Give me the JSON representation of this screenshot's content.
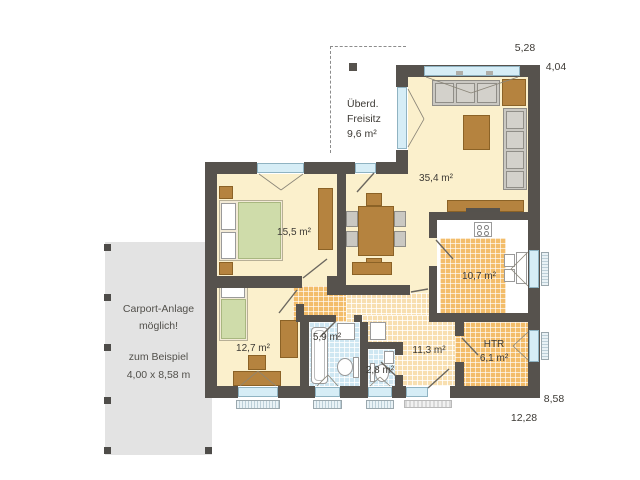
{
  "plan": {
    "rooms": [
      {
        "id": "living",
        "area_label": "35,4 m²"
      },
      {
        "id": "bedroom",
        "area_label": "15,5 m²"
      },
      {
        "id": "kitchen",
        "area_label": "10,7 m²"
      },
      {
        "id": "child_room",
        "area_label": "12,7 m²"
      },
      {
        "id": "bath",
        "area_label": "5,9 m²"
      },
      {
        "id": "wc",
        "area_label": "2,8 m²"
      },
      {
        "id": "hall",
        "area_label": "11,3 m²"
      },
      {
        "id": "htr",
        "name": "HTR",
        "area_label": "6,1 m²"
      }
    ],
    "freisitz": {
      "line1": "Überd.",
      "line2": "Freisitz",
      "line3": "9,6 m²"
    },
    "carport": {
      "line1": "Carport-Anlage",
      "line2": "möglich!",
      "line3": "zum Beispiel",
      "line4": "4,00 x 8,58 m"
    },
    "dimensions": {
      "width_top": "5,28",
      "height_top_right": "4,04",
      "height_right": "8,58",
      "width_bottom": "12,28"
    }
  },
  "colors": {
    "wall": "#56524d",
    "floor": "#fbf0cc",
    "tile_warm": "#f3bd6a",
    "tile_warm_light": "#f8dfb0",
    "tile_blue": "#cfe7f2",
    "window_glass": "#d6edf6",
    "furniture_wood": "#b5833f",
    "furniture_gray": "#cac8c2",
    "bed_green": "#cfdcaa",
    "carport_bg": "#e3e3e3"
  }
}
